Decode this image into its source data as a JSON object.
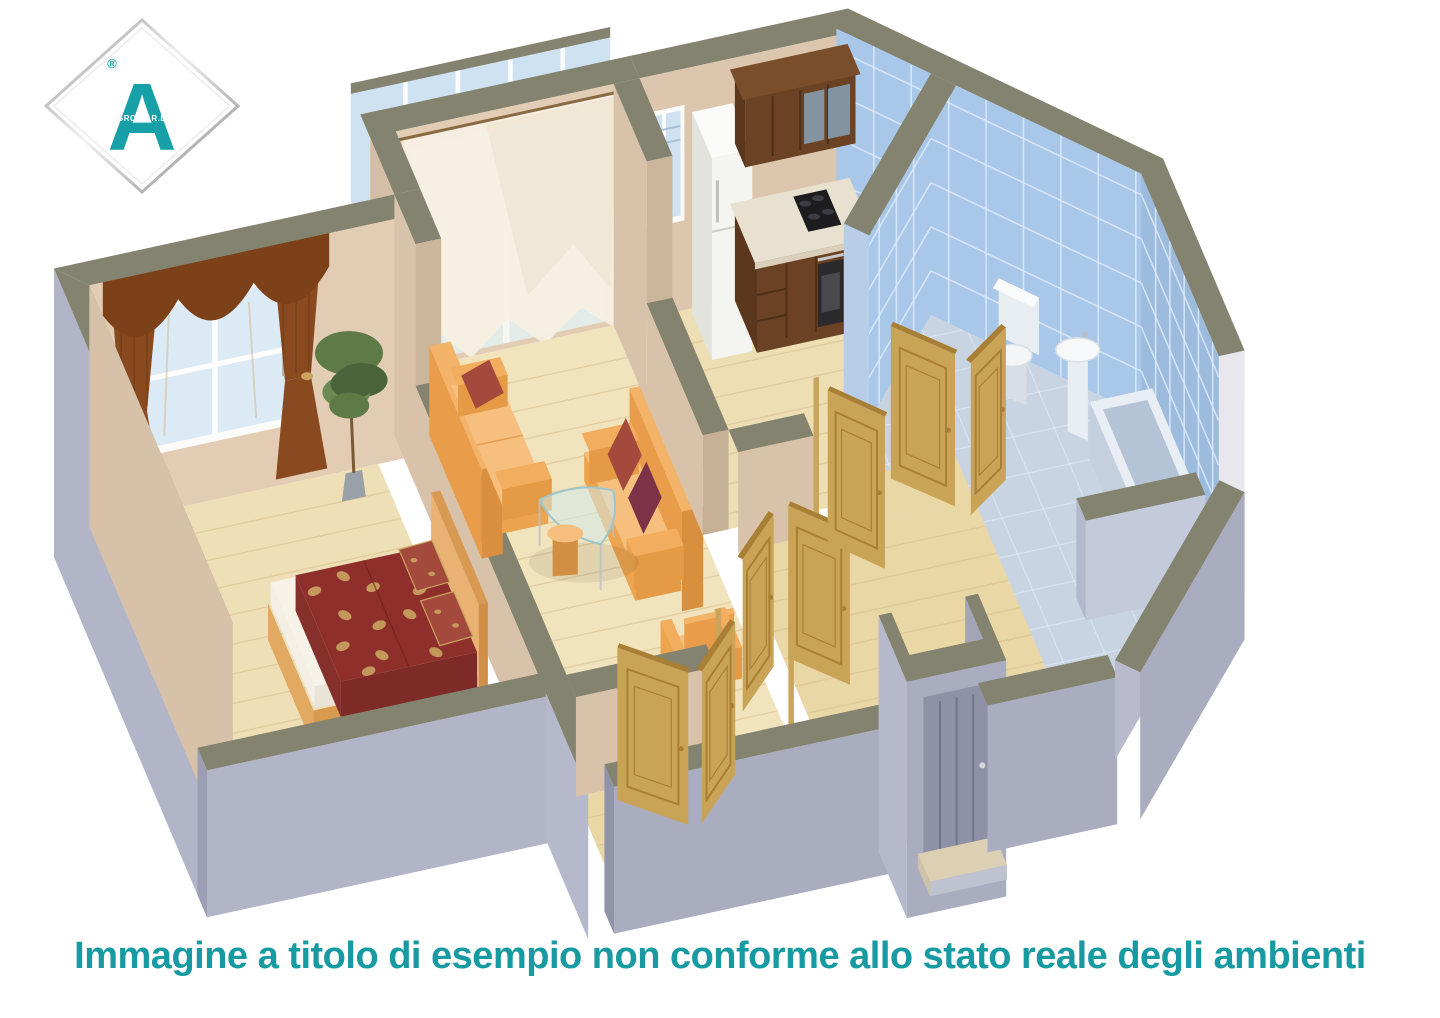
{
  "image_type": "3d-isometric-apartment-floor-plan-render",
  "logo": {
    "letter": "A",
    "registered_mark": "®",
    "sub_text": "GROUP R.E."
  },
  "caption": {
    "text": "Immagine a titolo di esempio non conforme allo stato reale degli ambienti"
  },
  "scene": {
    "rooms": [
      {
        "name": "bedroom",
        "contents": [
          "double-bed",
          "red-floral-bedspread",
          "two-pillows",
          "maroon-drapes-with-valance",
          "window",
          "potted-plant"
        ]
      },
      {
        "name": "living-room",
        "contents": [
          "orange-sofa",
          "orange-sofa",
          "glass-coffee-table",
          "orange-ottoman",
          "orange-armchair",
          "white-sheer-curtains",
          "balcony-door"
        ]
      },
      {
        "name": "balcony",
        "contents": [
          "glazed-panels"
        ]
      },
      {
        "name": "kitchen",
        "contents": [
          "white-refrigerator",
          "walnut-base-cabinets",
          "walnut-wall-cabinets",
          "built-in-oven",
          "black-cooktop",
          "window"
        ]
      },
      {
        "name": "bathroom",
        "contents": [
          "blue-wall-tiles",
          "toilet",
          "pedestal-sink",
          "bathtub"
        ]
      },
      {
        "name": "hallway",
        "contents": [
          "open-oak-doors",
          "entry-door",
          "doorstep"
        ]
      }
    ]
  },
  "palette": {
    "bg": "#ffffff",
    "caption_teal": "#179aa2",
    "logo_teal": "#18a0a8",
    "wall_inner": "#dcc7ae",
    "wall_inner_light": "#e2cdb4",
    "wall_inner_dim": "#d8c3aa",
    "wall_inner_shade": "#cbb69c",
    "wall_end": "#c6b197",
    "wall_top": "#84836f",
    "outer": "#b2b4c8",
    "outer_mid": "#aaacbf",
    "outer_dark": "#9c9eb3",
    "outer_deep": "#9193a8",
    "outer_light": "#b6b8cb",
    "floor": "#eedfb6",
    "floor_living": "#f1e3bc",
    "floor_kitchen": "#eddeb4",
    "floor_hall": "#ead7a6",
    "floor_bump": "#e5d09e",
    "floor_line": "#d6bd8e",
    "bath_floor": "#c9d4e2",
    "tile": "#a9c7e8",
    "tile_dark": "#9cbbdd",
    "grout": "#ddeafa",
    "glass": "#cfe2f2",
    "frame_white": "#fbfbf9",
    "sheer": "#f6f0e2",
    "sheer_shade": "#eadfca",
    "curtain": "#8a4a20",
    "curtain_dark": "#7c4119",
    "sofa_mid": "#e99c49",
    "sofa_top": "#f3b368",
    "sofa_arm": "#f2ae5e",
    "sofa_face": "#eda44f",
    "sofa_edge": "#e59a45",
    "sofa_light": "#f6bf7e",
    "pillow_light": "#a34a3c",
    "pillow_alt": "#7d3347",
    "bed_cover": "#8e2f2c",
    "bed_cover_dark": "#7e2a27",
    "bed_cover_side": "#86302b",
    "bed_gold": "#c9a45f",
    "bed_frame": "#e2a963",
    "bed_frame_dark": "#d79a4e",
    "headboard": "#e9b272",
    "headboard_dark": "#d89a52",
    "headboard_end": "#cf8f47",
    "mattress": "#f3efe6",
    "mattress_shade": "#e9e4d6",
    "mattress_top": "#f6f2e8",
    "door": "#c9a457",
    "door_dark": "#a97f35",
    "door_post": "#caa55c",
    "cabinet": "#6b4223",
    "cabinet_dark": "#4e2f17",
    "cabinet_side": "#5a371d",
    "cabinet_top": "#7a4e2a",
    "counter": "#e9e1cf",
    "counter_edge": "#d9cfba",
    "glass_cab": "#87a2b6",
    "fridge": "#f4f4f0",
    "fridge_side": "#e3e3dd",
    "fridge_top": "#fbfbf9",
    "fixture": "#f3f5f7",
    "fixture_dim": "#e8edf1",
    "fixture_shade": "#d8dee3",
    "tub_rim": "#e9eef5",
    "tub_side": "#c5d0df",
    "tub_front": "#bcc8d9",
    "tub_inner": "#b4c3d6",
    "bath_wall": "#c3cadb",
    "bath_wall_end": "#b2b9cc",
    "plant": "#5d7a47",
    "plant_dark": "#49633a",
    "plant_light": "#6d8a54",
    "trunk": "#7a5a34",
    "pot": "#9aa0a8",
    "dark_appliance": "#2b2b2e",
    "cooktop": "#1d1d20",
    "steel": "#c9c9cc",
    "balcony_floor": "#d9d4c4",
    "step_top": "#dccfb4",
    "step_face": "#bfc3cf",
    "entry_door": "#8f91a6",
    "entry_groove": "#73758a"
  }
}
